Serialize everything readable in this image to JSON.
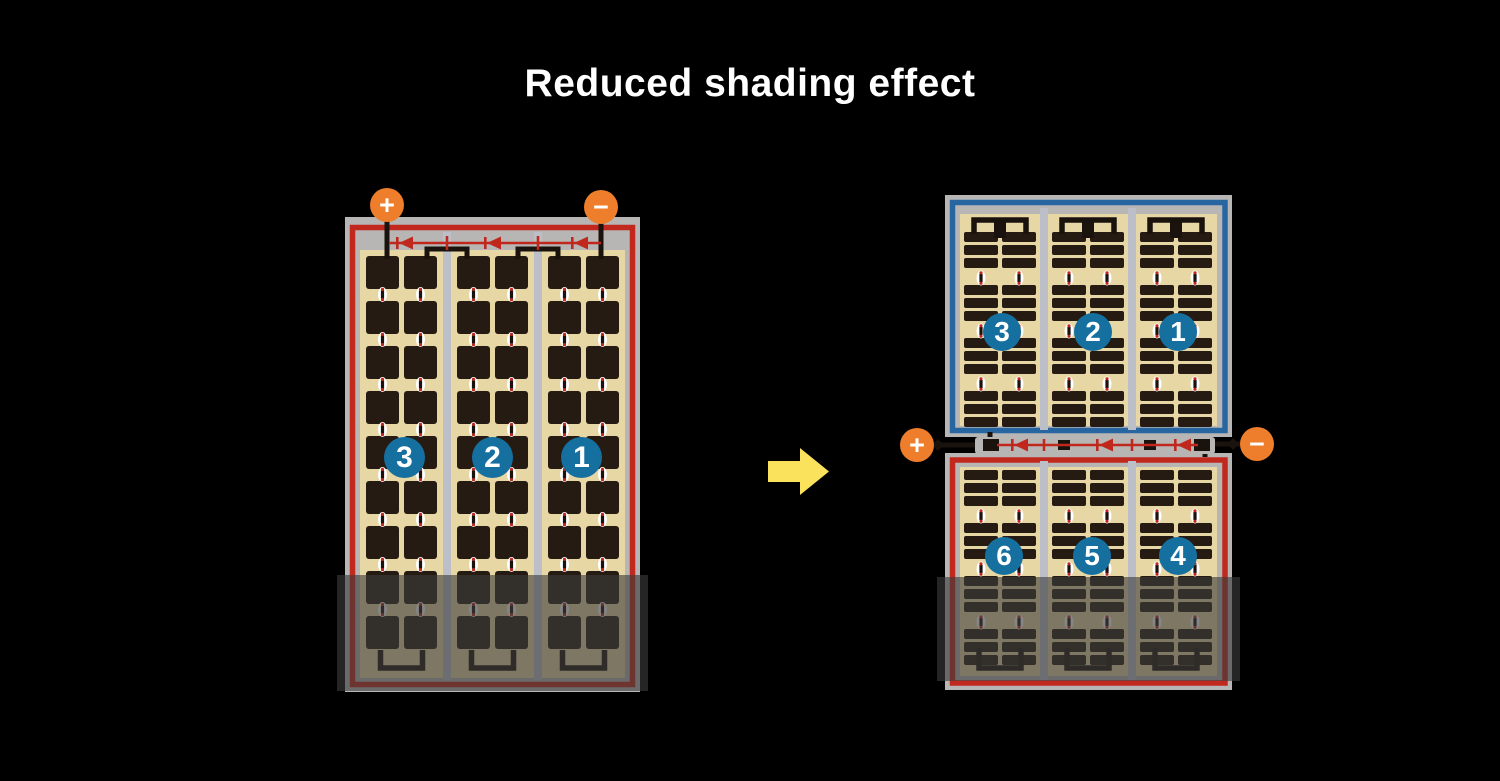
{
  "title": "Reduced shading effect",
  "left_module": {
    "description": "conventional full-cell module with bottom shading",
    "terminal_plus": "+",
    "terminal_minus": "−",
    "cell_group_labels": [
      "3",
      "2",
      "1"
    ]
  },
  "right_module": {
    "description": "half-cut cell module, split into two halves with center junction",
    "terminal_plus": "+",
    "terminal_minus": "−",
    "top_half_labels": [
      "3",
      "2",
      "1"
    ],
    "bottom_half_labels": [
      "6",
      "5",
      "4"
    ]
  },
  "colors": {
    "background": "#000000",
    "title_text": "#ffffff",
    "frame_gray": "#b7b6b5",
    "backsheet_cream": "#e7d7a5",
    "cell_dark": "#261b12",
    "divider_gray": "#bcbfc7",
    "border_red": "#c1281e",
    "border_blue": "#2766a0",
    "diode_red": "#c0281e",
    "wire_black": "#1a120c",
    "terminal_orange": "#ee7e2b",
    "group_label_blue": "#156f9f",
    "arrow_yellow": "#fae25c",
    "shade_overlay": "rgba(60,60,60,0.62)"
  }
}
